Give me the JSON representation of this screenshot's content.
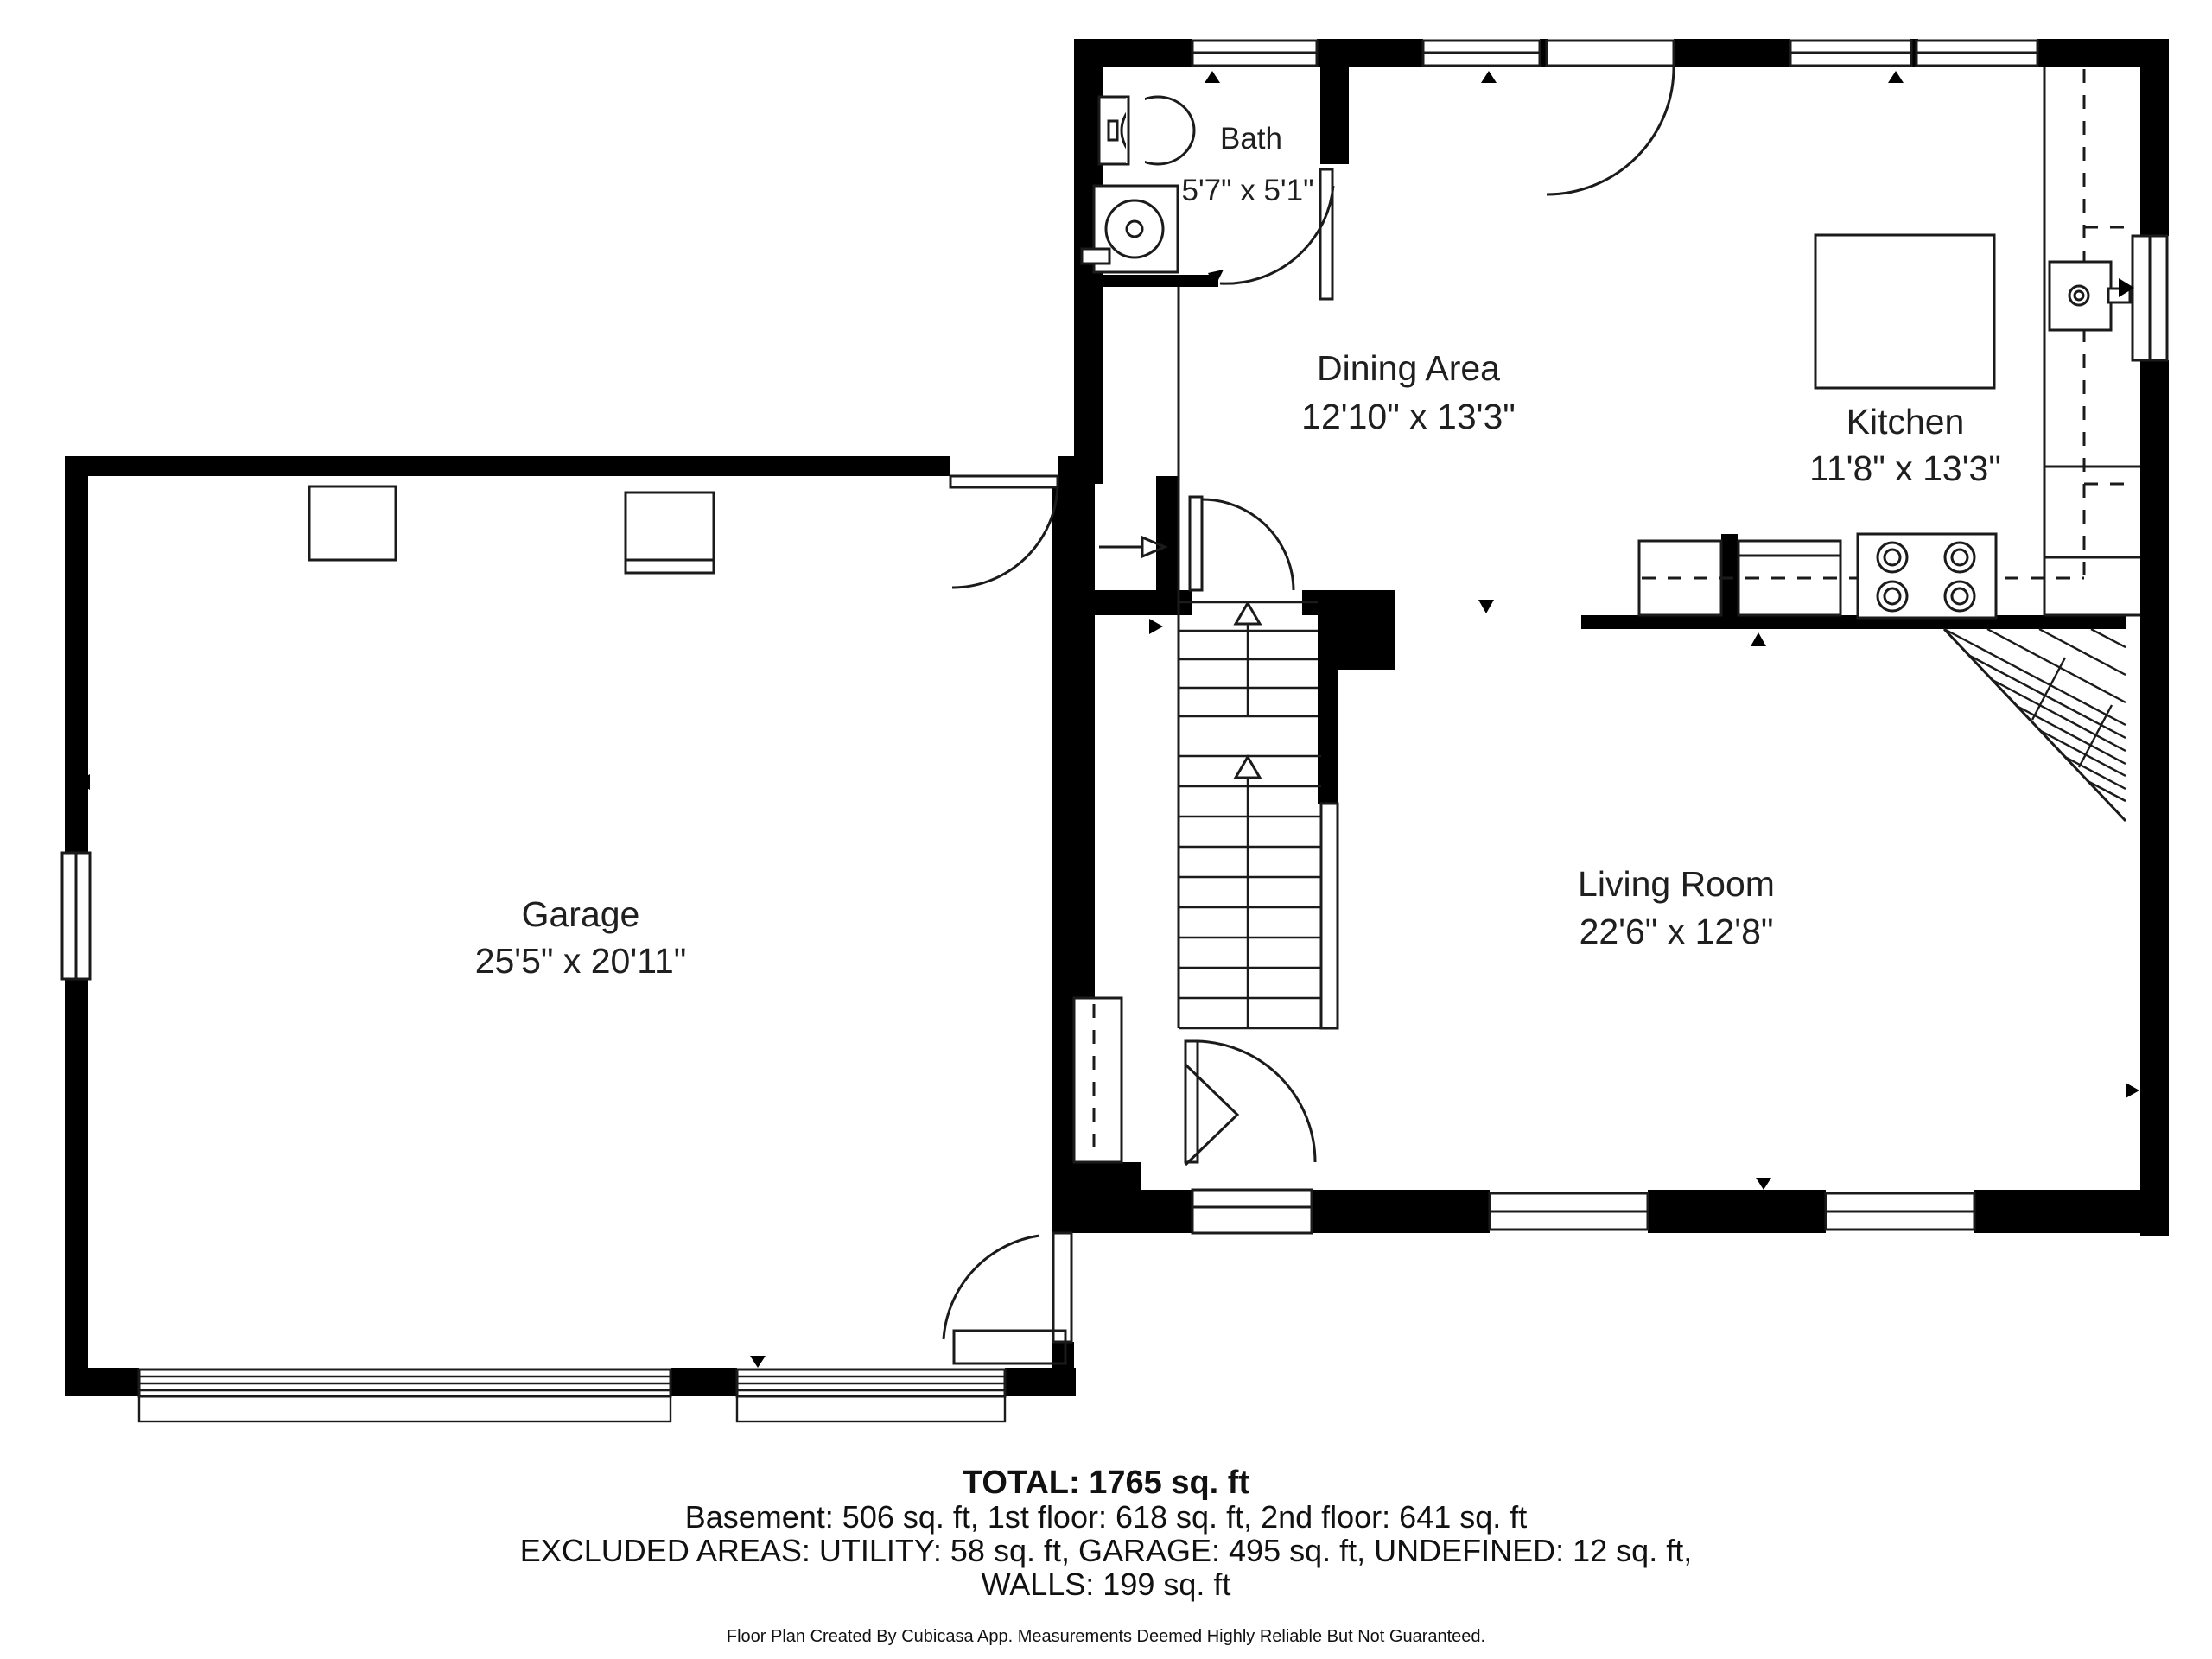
{
  "plan": {
    "rooms": {
      "bath": {
        "name": "Bath",
        "dims": "5'7\" x 5'1\""
      },
      "dining": {
        "name": "Dining Area",
        "dims": "12'10\" x 13'3\""
      },
      "kitchen": {
        "name": "Kitchen",
        "dims": "11'8\" x 13'3\""
      },
      "garage": {
        "name": "Garage",
        "dims": "25'5\" x 20'11\""
      },
      "living": {
        "name": "Living Room",
        "dims": "22'6\" x 12'8\""
      }
    },
    "colors": {
      "wall": "#000000",
      "line": "#1b1b1b",
      "background": "#ffffff"
    }
  },
  "summary": {
    "total": "TOTAL: 1765 sq. ft",
    "floors": "Basement: 506 sq. ft, 1st floor: 618 sq. ft, 2nd floor: 641 sq. ft",
    "excluded": "EXCLUDED AREAS: UTILITY: 58 sq. ft, GARAGE: 495 sq. ft, UNDEFINED: 12 sq. ft,",
    "walls": "WALLS: 199 sq. ft",
    "disclaimer": "Floor Plan Created By Cubicasa App. Measurements Deemed Highly Reliable But Not Guaranteed."
  }
}
